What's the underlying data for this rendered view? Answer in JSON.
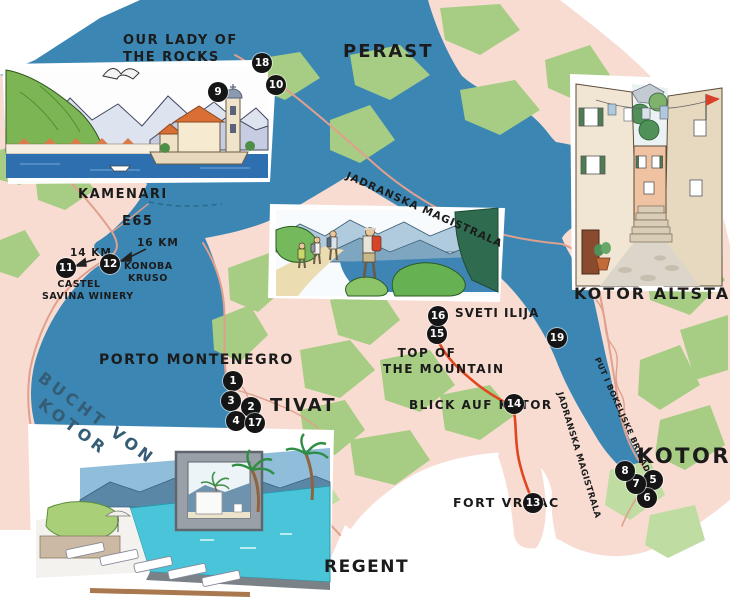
{
  "map": {
    "region_labels": {
      "perast": "PERAST",
      "tivat": "TIVAT",
      "kotor": "KOTOR",
      "kamenari": "KAMENARI",
      "kotor_altstadt": "KOTOR ALTSTADT",
      "bucht_von_kotor": {
        "line1": "BUCHT VON",
        "line2": "KOTOR"
      }
    },
    "poi_labels": {
      "our_lady": {
        "line1": "OUR LADY OF",
        "line2": "THE ROCKS"
      },
      "porto_montenegro": "PORTO MONTENEGRO",
      "sveti_ilija": "SVETI ILIJA",
      "top_of_the_mountain": {
        "line1": "TOP OF",
        "line2": "THE MOUNTAIN"
      },
      "blick_auf_kotor": "BLICK AUF KOTOR",
      "fort_vrmac": "FORT VRMAC",
      "konoba_kruso": {
        "line1": "KONOBA",
        "line2": "KRUSO"
      },
      "castel_savina": {
        "line1": "CASTEL",
        "line2": "SAVINA WINERY"
      },
      "regent": "REGENT"
    },
    "road_labels": {
      "e65": "E65",
      "jadranska_magistrala_north": "JADRANSKA MAGISTRALA",
      "jadranska_magistrala_south": "JADRANSKA MAGISTRALA",
      "put_i_bokeljske_brigade": "PUT I BOKELJSKE BRIGADE"
    },
    "distance_labels": {
      "to_castel_savina": "14 KM",
      "to_konoba_kruso": "16 KM"
    },
    "colors": {
      "water": "#3C86B4",
      "land": "#F8DCD2",
      "vegetation": "#A6CD83",
      "vegetation_light": "#BFDCA2",
      "road": "#DFA08D",
      "hiking_trail": "#E0461F",
      "marker_background": "#151515",
      "marker_text": "#FFFFFF",
      "bay_label_text": "#345D75",
      "label_text": "#1B1B1B"
    }
  },
  "markers": {
    "m1": "1",
    "m2": "2",
    "m3": "3",
    "m4": "4",
    "m5": "5",
    "m6": "6",
    "m7": "7",
    "m8": "8",
    "m9": "9",
    "m10": "10",
    "m11": "11",
    "m12": "12",
    "m13": "13",
    "m14": "14",
    "m15": "15",
    "m16": "16",
    "m17": "17",
    "m18": "18",
    "m19": "19"
  }
}
